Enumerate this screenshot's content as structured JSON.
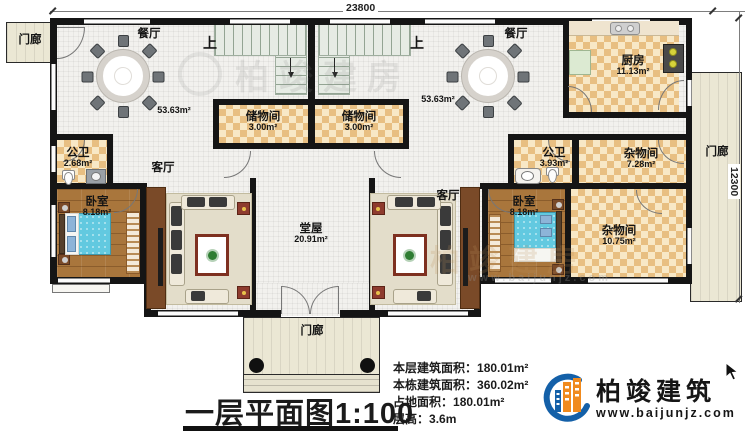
{
  "dimensions": {
    "width_label": "23800",
    "depth_label": "12300"
  },
  "rooms": {
    "porch_top_left": {
      "name": "门廊"
    },
    "porch_right": {
      "name": "门廊"
    },
    "porch_bottom": {
      "name": "门廊"
    },
    "dining_left": {
      "name": "餐厅",
      "area": "53.63m²"
    },
    "dining_right": {
      "name": "餐厅",
      "area": "53.63m²"
    },
    "stairs_left": {
      "label": "上"
    },
    "stairs_right": {
      "label": "上"
    },
    "storage_left": {
      "name": "储物间",
      "area": "3.00m²"
    },
    "storage_right": {
      "name": "储物间",
      "area": "3.00m²"
    },
    "kitchen": {
      "name": "厨房",
      "area": "11.13m²"
    },
    "bath_left": {
      "name": "公卫",
      "area": "2.68m²"
    },
    "bath_right": {
      "name": "公卫",
      "area": "3.93m²"
    },
    "living_left": {
      "name": "客厅"
    },
    "living_right": {
      "name": "客厅"
    },
    "bedroom_left": {
      "name": "卧室",
      "area": "8.18m²"
    },
    "bedroom_right": {
      "name": "卧室",
      "area": "8.18m²"
    },
    "hall": {
      "name": "堂屋",
      "area": "20.91m²"
    },
    "utility_small": {
      "name": "杂物间",
      "area": "7.28m²"
    },
    "utility_large": {
      "name": "杂物间",
      "area": "10.75m²"
    }
  },
  "title": {
    "text": "一层平面图1:100"
  },
  "info": {
    "lines": [
      {
        "label": "本层建筑面积：",
        "value": "180.01m²"
      },
      {
        "label": "本栋建筑面积：",
        "value": "360.02m²"
      },
      {
        "label": "占地面积：",
        "value": "180.01m²"
      },
      {
        "label": "层高：",
        "value": "3.6m"
      }
    ]
  },
  "logo": {
    "company": "柏竣建筑",
    "website": "www.baijunjz.com"
  },
  "watermark": {
    "text": "柏竣建房",
    "website": "www.baijunjz.com"
  },
  "colors": {
    "wall": "#151515",
    "checker_floor": "#e8bf82",
    "wood_floor": "#a9763c",
    "bed": "#62c9e0",
    "porch": "#ebe7d4",
    "accent_red": "#8e3b2e",
    "logo_blue": "#1460a8",
    "logo_orange": "#f08a1e"
  }
}
